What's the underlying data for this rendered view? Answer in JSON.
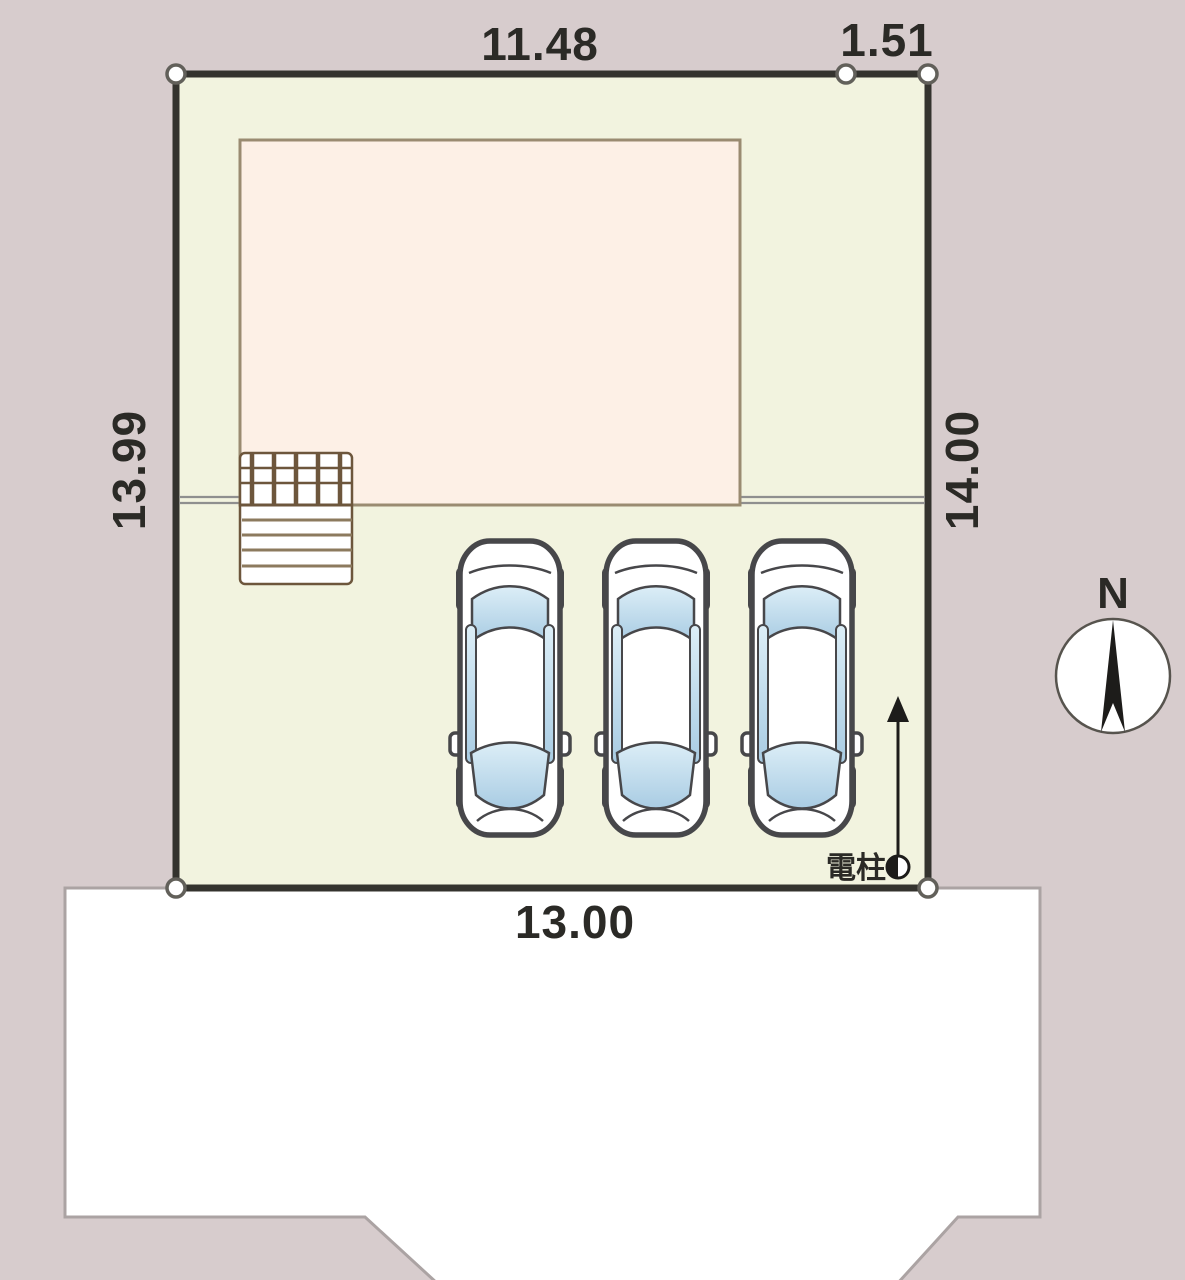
{
  "drawing": {
    "type": "residential-site-plan",
    "north_label": "N",
    "utility_pole_label": "電柱"
  },
  "dimensions": {
    "top": "11.48",
    "top_right": "1.51",
    "left": "13.99",
    "right": "14.00",
    "bottom": "13.00"
  },
  "objects": {
    "car_count": 3,
    "boundary_point_count": 5,
    "has_utility_pole": true,
    "has_north_compass": true,
    "has_porch_steps": true
  },
  "colors": {
    "background": "#d7cccd",
    "lot_fill": "#f2f3df",
    "lot_border": "#34332e",
    "building_fill": "#fdf0e6",
    "building_border": "#9a8b71",
    "road_fill": "#ffffff",
    "road_edge": "#aba3a3",
    "setback_line": "#8f8f8f",
    "porch_line": "#6d563c",
    "car_outline": "#47474a",
    "car_glass_light": "#dceef7",
    "car_glass_dark": "#a9cce3",
    "dimension_text": "#2b2a26"
  }
}
